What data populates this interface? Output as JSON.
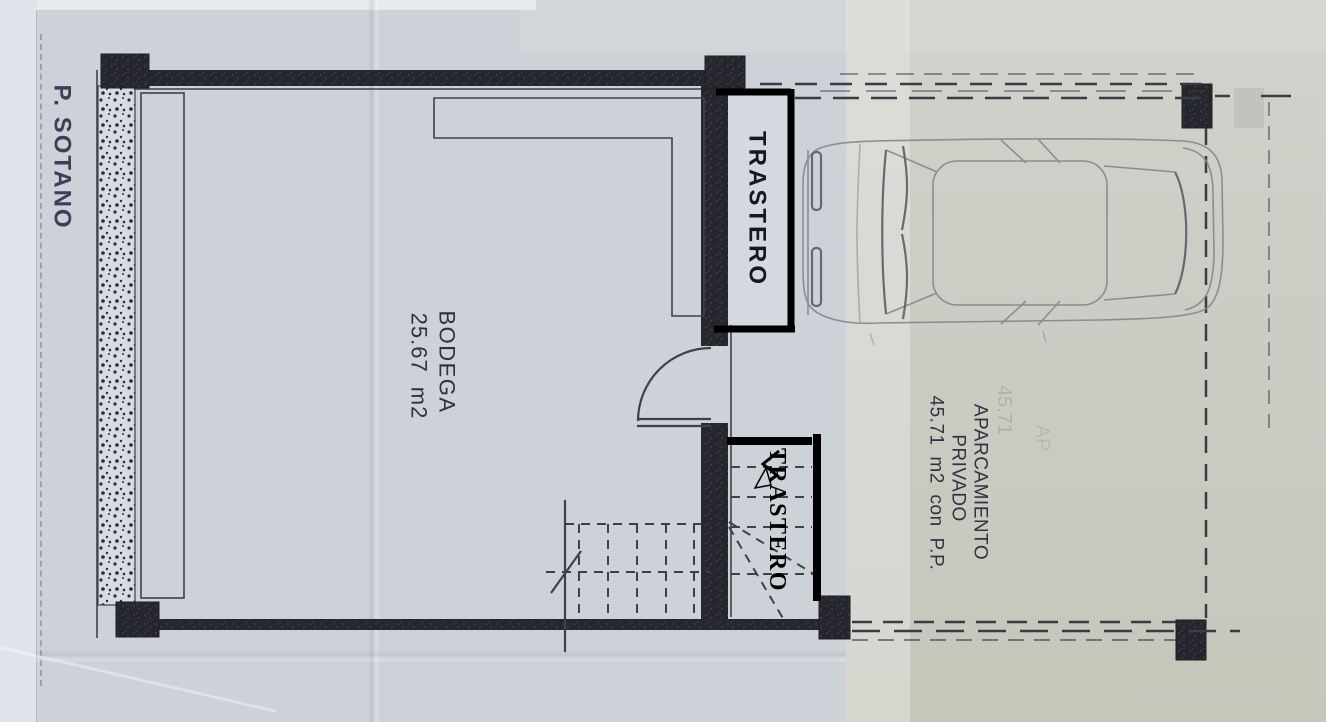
{
  "plan": {
    "level_title": "P. SOTANO",
    "rooms": {
      "bodega": {
        "label": "BODEGA",
        "area": "25.67 m2"
      },
      "trastero_upper": {
        "label": "TRASTERO"
      },
      "trastero_lower": {
        "label": "TRASTERO"
      },
      "aparcamiento": {
        "label_line1": "APARCAMIENTO",
        "label_line2": "PRIVADO",
        "area_line": "45.71 m2 con P.P."
      }
    },
    "ghost_texts": {
      "area": "45.71",
      "partial": "AP"
    }
  },
  "colors": {
    "paper_left": "#cdd1d8",
    "paper_right": "#c8cabf",
    "wall": "#27282e",
    "ink": "#3c4150",
    "bold_overlay": "#000000",
    "pencil": "#83868f",
    "pencil_dark": "#5a5e69",
    "title_ink": "#394058",
    "label_ink": "#2e3442"
  }
}
